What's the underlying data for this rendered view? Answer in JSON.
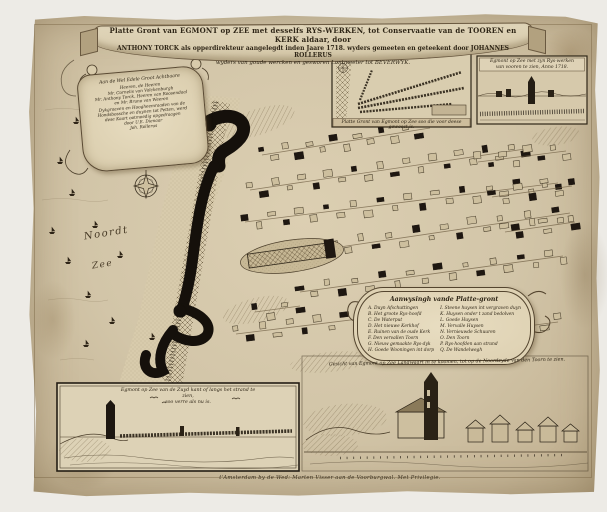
{
  "palette": {
    "paper": "#d2c5a8",
    "ink": "#2e2516",
    "engraving_black": "#17110b",
    "band": "#cdbd9c"
  },
  "map": {
    "title_line1": "Platte Gront van EGMONT op ZEE met desselfs RYS-WERKEN, tot Conservaatie van de TOOREN en KERK aldaar, door",
    "title_line2": "ANTHONY TORCK als opperdirekteur aangelegdt inden Jaare 1718. wyders gemeeten en geteekent door JOHANNES ROLLERUS",
    "title_line3": "wyders van goude wercken en gesworen Lantmeeter tot BEVERWYK.",
    "dedication_heading": "Aan de Wel Edele Groot Achtbaare",
    "dedication_lines": [
      "Heeren, de Heeren",
      "Mr. Cornelis van Valckenburgh",
      "Mr. Anthony Torck, Heeren van Roosendaal",
      "en Mr. Bruno van Weeren",
      "Dykgraaven en Hoogheemraaden van de",
      "Hondsbossche en duynen tot Petten, werd",
      "dese Kaart ootmoedig opgedraagen",
      "door U.E. Dienaar",
      "Joh. Rollerus"
    ],
    "sea_label_top": "Noordt",
    "sea_label_bottom": "Zee",
    "inset_old_plan_caption": "Platte Gront van Egmont op Zee soo die voor deese geweest is.",
    "inset_front_view_caption_line1": "Egmont op Zee met zyn Rys-werken",
    "inset_front_view_caption_line2": "van vooren te zien, Anno 1718.",
    "legend_title": "Aanwysingh vande Platte-gront",
    "legend_left": [
      "A. Duyn Afschuttingen",
      "B. Het groote Rys-hoofd",
      "C. De Waterput",
      "D. Het nieuwe Kerkhof",
      "E. Ruinen van de oude Kerk",
      "F. Den vervallen Toorn",
      "G. Nieuw gemaakte Rys-dyk",
      "H. Goede Wooningen int dorp"
    ],
    "legend_right": [
      "I. Steene huysen int vergraven duyn",
      "K. Huysen onder t zand bedolven",
      "L. Goede Huysen",
      "M. Vervalle Huysen",
      "N. Vernieuwde Schuuren",
      "O. Den Toorn",
      "P. Rys-hoofden aan strand",
      "Q. De Wandelwegh"
    ],
    "view_south_caption_line1": "Egmont op Zee van de Zuyd kant of langs het strand te zien,",
    "view_south_caption_line2": "soo verre als nu is.",
    "view_land_banner": "Gesicht van Egmont op Zee Landwaart in te koomen, tot op de Noordzyde van den Toorn te zien.",
    "imprint": "t'Amsterdam by de Wed: Marten Visser aan de Voorburgwal. Met Privilegie."
  }
}
